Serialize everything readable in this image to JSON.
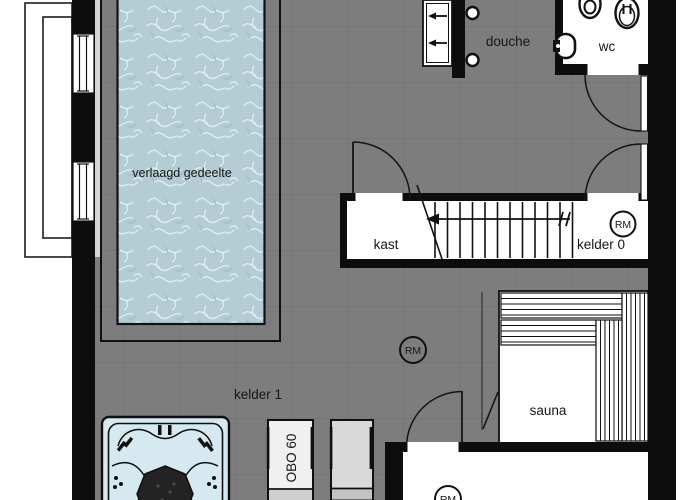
{
  "labels": {
    "pool": "verlaagd gedeelte",
    "shower": "douche",
    "wc": "wc",
    "closet": "kast",
    "basement0": "kelder 0",
    "basement1": "kelder 1",
    "sauna": "sauna",
    "appliance": "OBO 60",
    "smoke_detector": "RM"
  },
  "colors": {
    "wall": "#0d0d0d",
    "floor": "#7d7d7d",
    "room_white": "#ffffff",
    "pool_water": "#b4cdd5",
    "hot_tub": "#d6e9f0",
    "appliance_light": "#f0f0f0",
    "appliance_gray": "#d9d9d9"
  }
}
